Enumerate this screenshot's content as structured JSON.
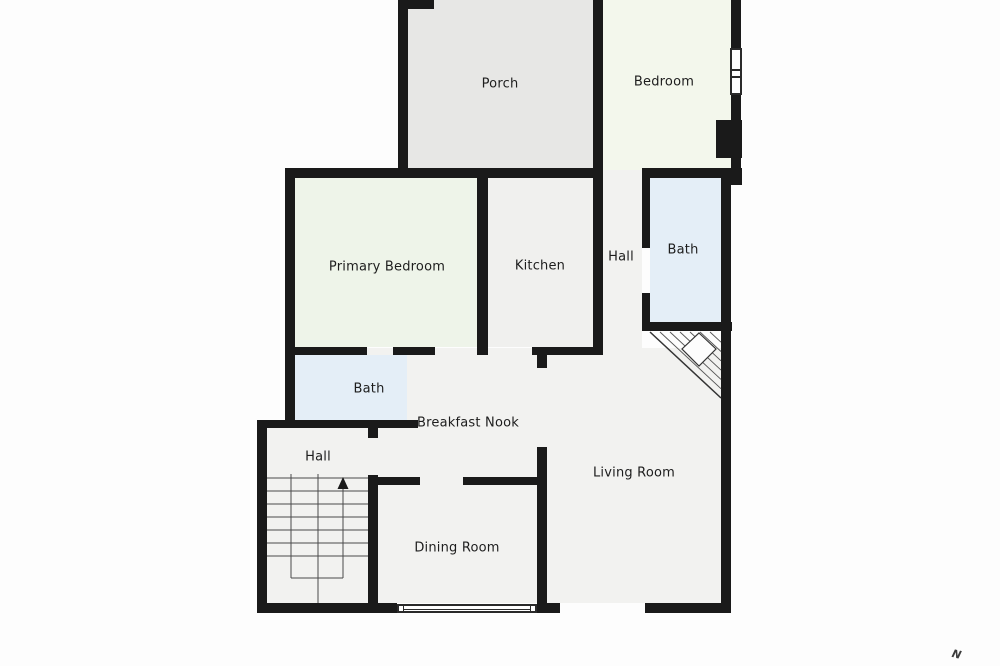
{
  "plan": {
    "title": "floor-plan",
    "compass": "N",
    "rooms": {
      "porch": {
        "label": "Porch"
      },
      "bedroom": {
        "label": "Bedroom"
      },
      "primary_bedroom": {
        "label": "Primary Bedroom"
      },
      "kitchen": {
        "label": "Kitchen"
      },
      "hall_upper": {
        "label": "Hall"
      },
      "bath_upper": {
        "label": "Bath"
      },
      "bath_lower": {
        "label": "Bath"
      },
      "hall_lower": {
        "label": "Hall"
      },
      "breakfast_nook": {
        "label": "Breakfast Nook"
      },
      "dining_room": {
        "label": "Dining Room"
      },
      "living_room": {
        "label": "Living Room"
      }
    },
    "colors": {
      "wall": "#1a1a1a",
      "porch_fill": "#e7e7e5",
      "bedroom_fill": "#f3f7ec",
      "primary_fill": "#eef4e9",
      "kitchen_fill": "#f0f0ee",
      "bath_fill": "#e4eef7",
      "neutral_fill": "#f2f2f0",
      "background": "#fdfdfd",
      "label": "#1d1d1d",
      "stair_line": "#4a4a4a"
    }
  }
}
